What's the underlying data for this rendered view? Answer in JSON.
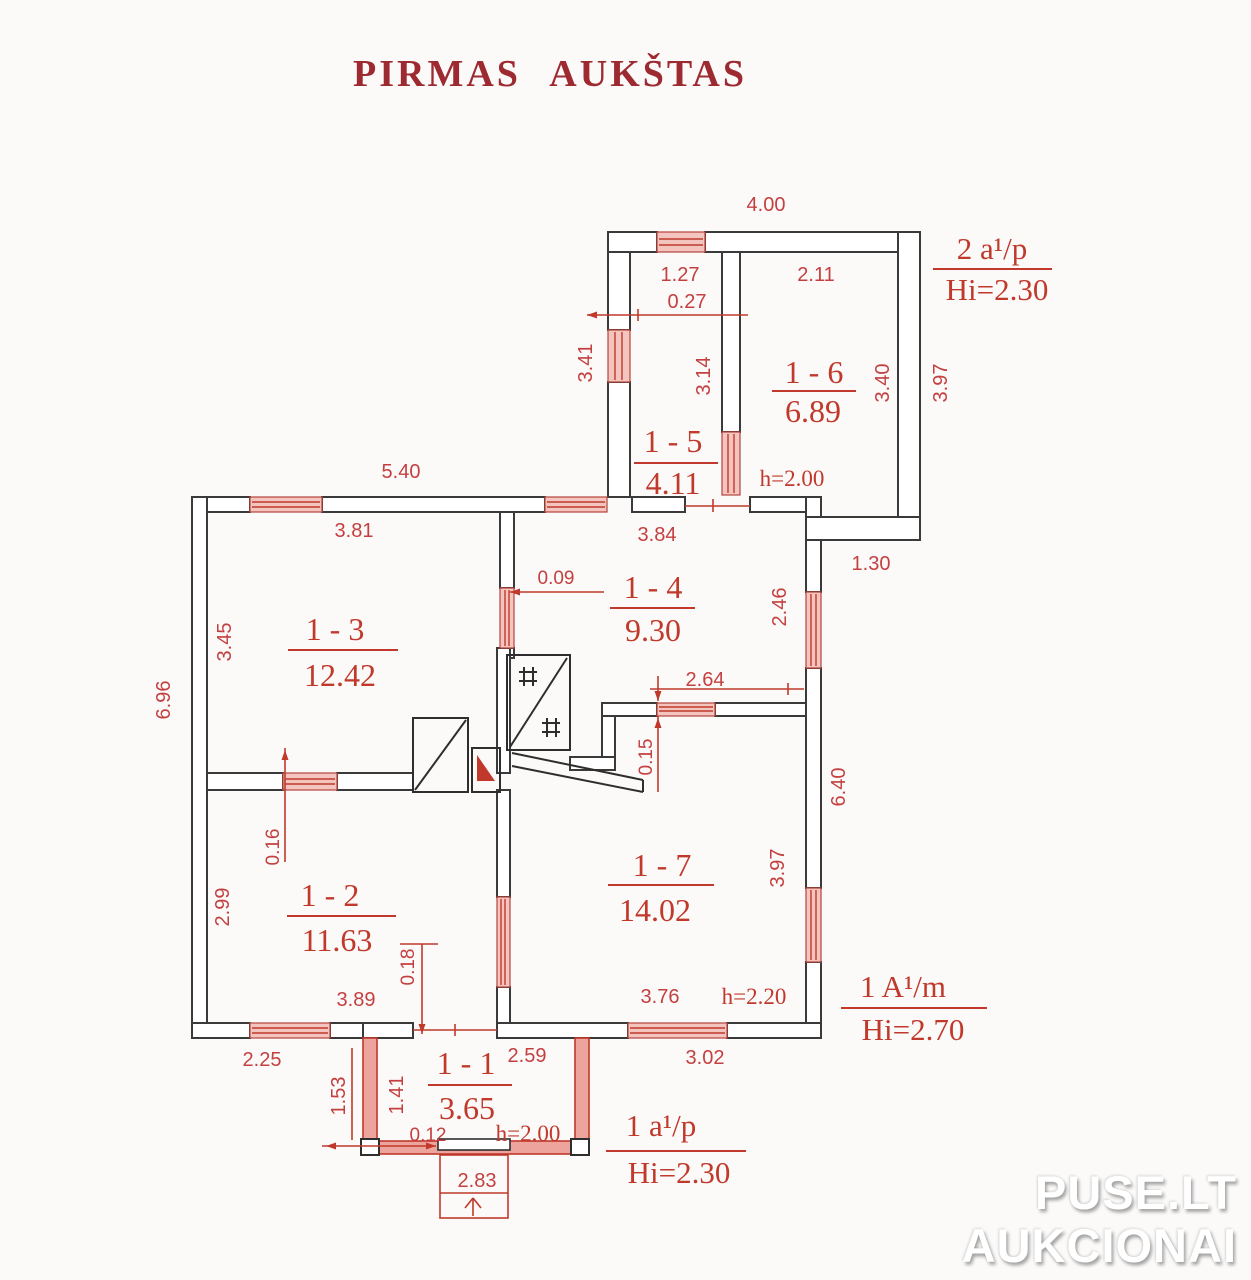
{
  "title": "PIRMAS AUKŠTAS",
  "watermark": {
    "line1": "PUSE.LT",
    "line2": "AUKCIONAI"
  },
  "rooms": {
    "r1": {
      "id": "1 - 1",
      "area": "3.65"
    },
    "r2": {
      "id": "1 - 2",
      "area": "11.63"
    },
    "r3": {
      "id": "1 - 3",
      "area": "12.42"
    },
    "r4": {
      "id": "1 - 4",
      "area": "9.30"
    },
    "r5": {
      "id": "1 - 5",
      "area": "4.11"
    },
    "r6": {
      "id": "1 - 6",
      "area": "6.89"
    },
    "r7": {
      "id": "1 - 7",
      "area": "14.02"
    }
  },
  "zones": {
    "annex": {
      "label": "2 a¹/p",
      "hi": "Hi=2.30"
    },
    "main": {
      "label": "1 A¹/m",
      "hi": "Hi=2.70"
    },
    "porch": {
      "label": "1 a¹/p",
      "hi": "Hi=2.30"
    }
  },
  "dims": {
    "d400": "4.00",
    "d127": "1.27",
    "d027": "0.27",
    "d211": "2.11",
    "d341": "3.41",
    "d314": "3.14",
    "d340": "3.40",
    "d397a": "3.97",
    "h200a": "h=2.00",
    "d540": "5.40",
    "d381": "3.81",
    "d384": "3.84",
    "d130": "1.30",
    "d009": "0.09",
    "d246": "2.46",
    "d345": "3.45",
    "d264": "2.64",
    "d696": "6.96",
    "d015": "0.15",
    "d640": "6.40",
    "d016": "0.16",
    "d299": "2.99",
    "d397b": "3.97",
    "d018": "0.18",
    "d389": "3.89",
    "d376": "3.76",
    "h220": "h=2.20",
    "d225": "2.25",
    "d259": "2.59",
    "d302": "3.02",
    "d153": "1.53",
    "d141": "1.41",
    "d012": "0.12",
    "h200b": "h=2.00",
    "d283": "2.83"
  },
  "colors": {
    "dim_red": "#c0392b",
    "title_red": "#9d2a30",
    "wall": "#3a3a3a",
    "window_fill": "#f4c5bf"
  }
}
